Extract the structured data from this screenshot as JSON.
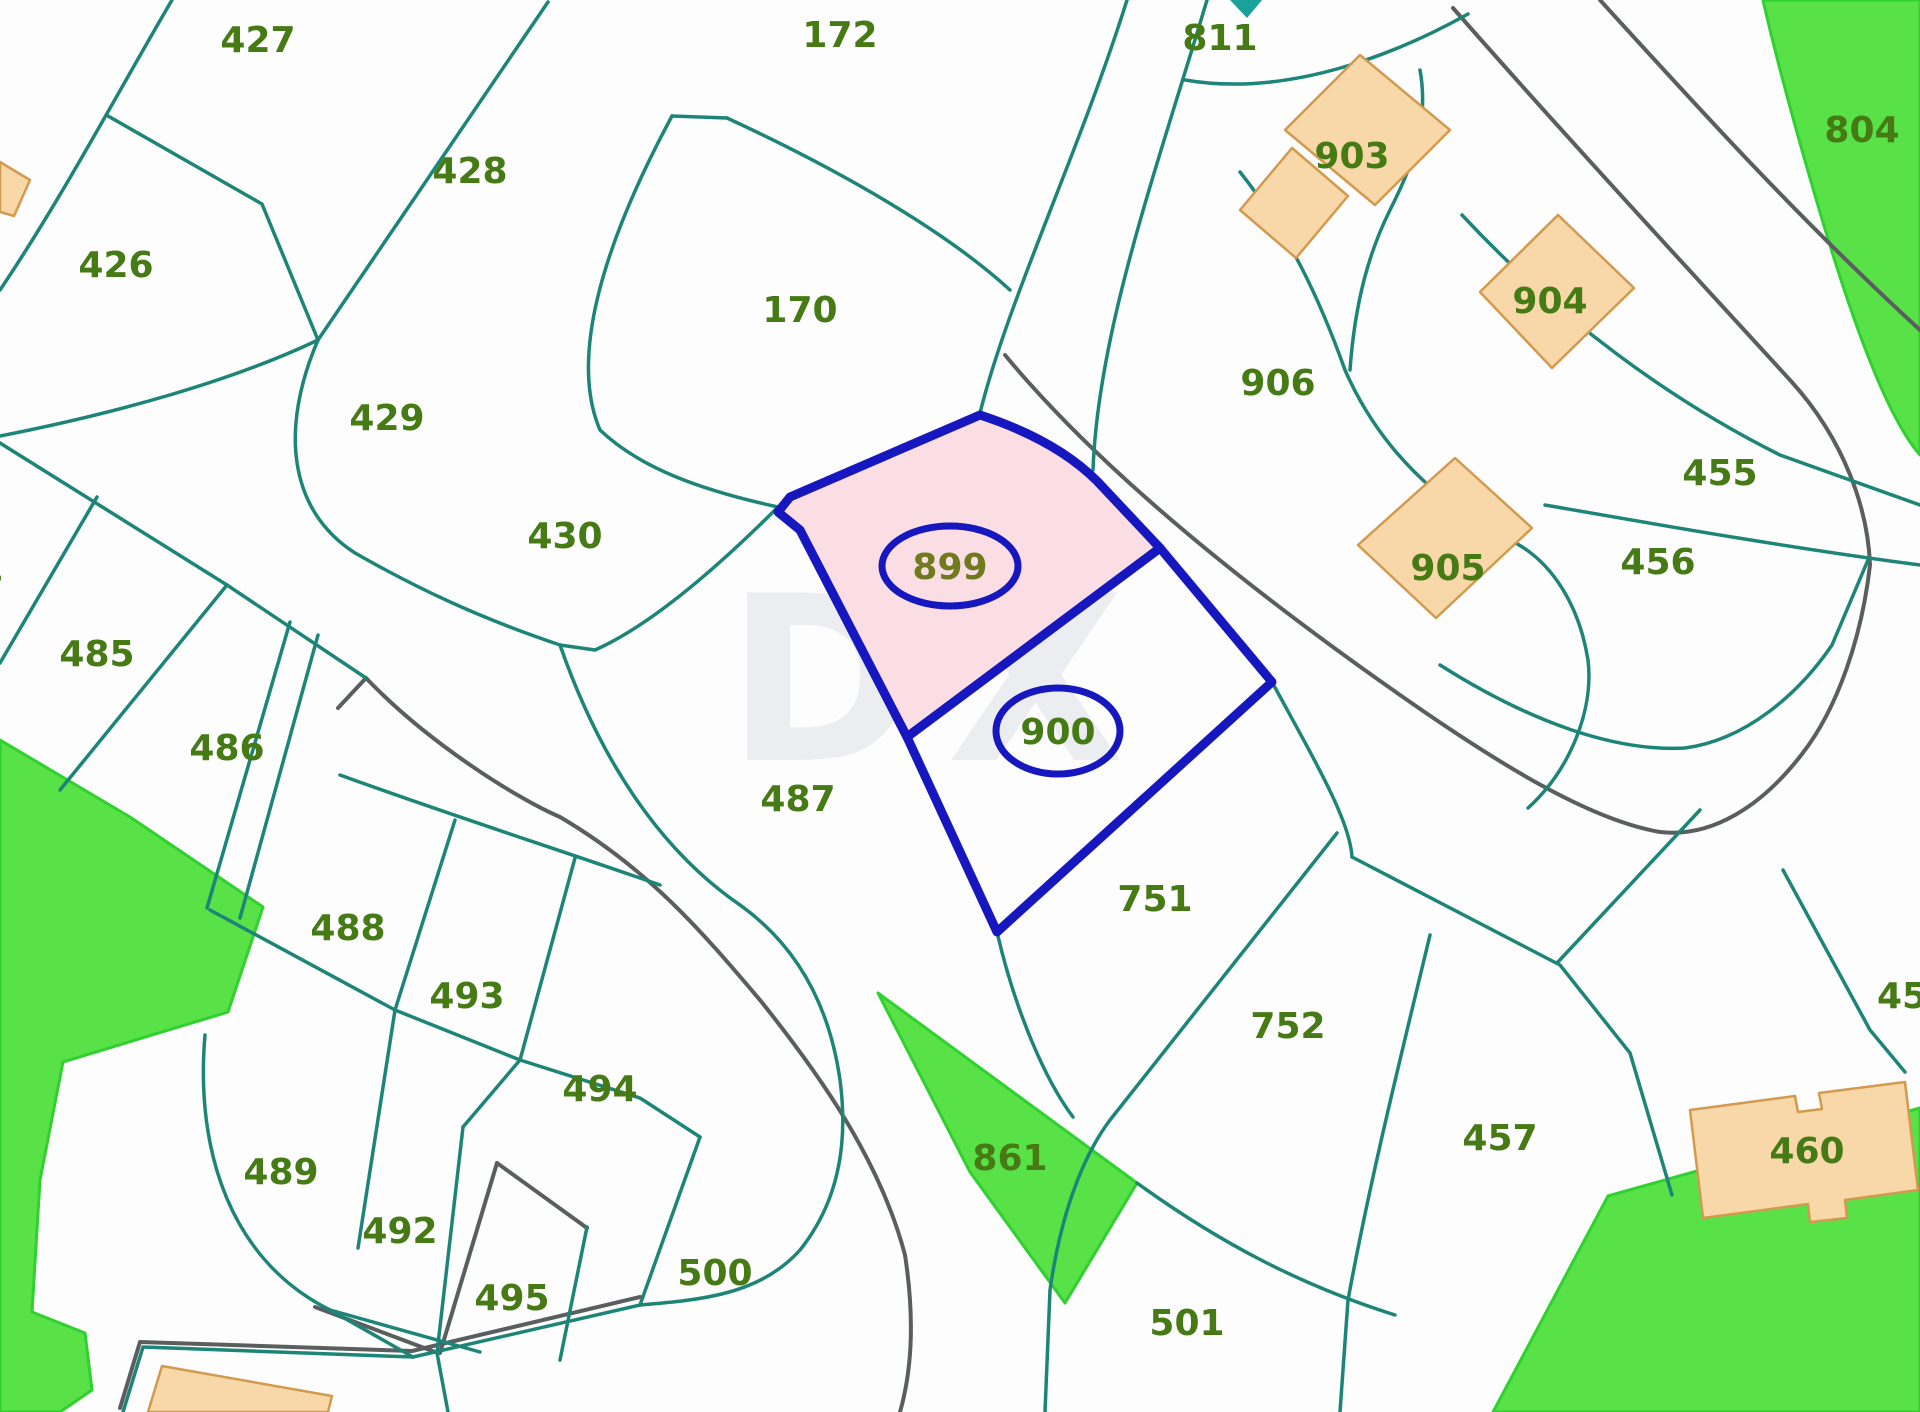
{
  "map": {
    "title": "cadastral-parcel-map",
    "watermark": "DX",
    "background": "#fdfdfd"
  },
  "colors": {
    "parcel_line": "#1d8578",
    "road_line": "#5b5e5e",
    "green_area_fill": "#59e148",
    "green_area_stroke": "#2fd02f",
    "building_fill": "#f8d8a8",
    "building_stroke": "#d29a4e",
    "highlight_outline": "#1717c0",
    "highlight_fill": "#fadee4",
    "label_green": "#467a14",
    "label_olive": "#6f7b1e"
  },
  "highlight": {
    "selected_parcel": "899",
    "secondary_parcel": "900"
  },
  "parcels": [
    {
      "label": "427",
      "x": 258,
      "y": 52,
      "style": "green"
    },
    {
      "label": "172",
      "x": 840,
      "y": 47,
      "style": "green"
    },
    {
      "label": "811",
      "x": 1220,
      "y": 50,
      "style": "green"
    },
    {
      "label": "426",
      "x": 116,
      "y": 277,
      "style": "green"
    },
    {
      "label": "428",
      "x": 470,
      "y": 183,
      "style": "green"
    },
    {
      "label": "903",
      "x": 1352,
      "y": 168,
      "style": "green"
    },
    {
      "label": "804",
      "x": 1862,
      "y": 142,
      "style": "green"
    },
    {
      "label": "904",
      "x": 1550,
      "y": 313,
      "style": "green"
    },
    {
      "label": "170",
      "x": 800,
      "y": 322,
      "style": "green"
    },
    {
      "label": "429",
      "x": 387,
      "y": 430,
      "style": "green"
    },
    {
      "label": "906",
      "x": 1278,
      "y": 395,
      "style": "green"
    },
    {
      "label": "455",
      "x": 1720,
      "y": 485,
      "style": "green"
    },
    {
      "label": "430",
      "x": 565,
      "y": 548,
      "style": "green"
    },
    {
      "label": "905",
      "x": 1448,
      "y": 580,
      "style": "green"
    },
    {
      "label": "456",
      "x": 1658,
      "y": 574,
      "style": "green"
    },
    {
      "label": "899",
      "x": 950,
      "y": 579,
      "style": "olive"
    },
    {
      "label": "485",
      "x": 97,
      "y": 666,
      "style": "green"
    },
    {
      "label": "4",
      "x": -10,
      "y": 585,
      "style": "green"
    },
    {
      "label": "486",
      "x": 227,
      "y": 760,
      "style": "green"
    },
    {
      "label": "900",
      "x": 1058,
      "y": 744,
      "style": "green"
    },
    {
      "label": "487",
      "x": 798,
      "y": 811,
      "style": "green"
    },
    {
      "label": "751",
      "x": 1155,
      "y": 911,
      "style": "green"
    },
    {
      "label": "488",
      "x": 348,
      "y": 940,
      "style": "green"
    },
    {
      "label": "493",
      "x": 467,
      "y": 1008,
      "style": "green"
    },
    {
      "label": "45",
      "x": 1902,
      "y": 1008,
      "style": "green"
    },
    {
      "label": "752",
      "x": 1288,
      "y": 1038,
      "style": "green"
    },
    {
      "label": "494",
      "x": 600,
      "y": 1101,
      "style": "green"
    },
    {
      "label": "861",
      "x": 1010,
      "y": 1170,
      "style": "green"
    },
    {
      "label": "489",
      "x": 281,
      "y": 1184,
      "style": "green"
    },
    {
      "label": "457",
      "x": 1500,
      "y": 1150,
      "style": "green"
    },
    {
      "label": "460",
      "x": 1807,
      "y": 1163,
      "style": "green"
    },
    {
      "label": "492",
      "x": 400,
      "y": 1243,
      "style": "green"
    },
    {
      "label": "500",
      "x": 715,
      "y": 1285,
      "style": "green"
    },
    {
      "label": "495",
      "x": 512,
      "y": 1310,
      "style": "green"
    },
    {
      "label": "501",
      "x": 1187,
      "y": 1335,
      "style": "green"
    }
  ]
}
